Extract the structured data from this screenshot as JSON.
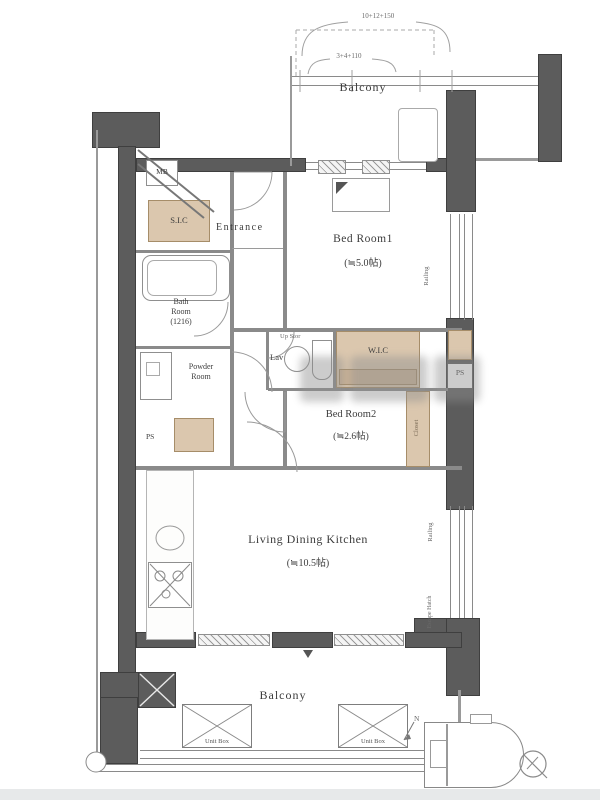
{
  "labels": {
    "balcony_top": "Balcony",
    "balcony_bottom": "Balcony",
    "dim_outer": "10+12+150",
    "dim_inner": "3+4+110",
    "mb": "MB",
    "sic": "S.I.C",
    "entrance": "Entrance",
    "bedroom1_name": "Bed Room1",
    "bedroom1_size": "(≒5.0帖)",
    "bedroom2_name": "Bed Room2",
    "bedroom2_size": "(≒2.6帖)",
    "ldk_name": "Living Dining Kitchen",
    "ldk_size": "(≒10.5帖)",
    "bath_1": "Bath",
    "bath_2": "Room",
    "bath_3": "(1216)",
    "powder_1": "Powder",
    "powder_2": "Room",
    "lav": "Lav",
    "up_stor": "Up Stor",
    "wic": "W.I.C",
    "closet": "Closet",
    "ps_left": "PS",
    "ps_right": "PS",
    "railing_upper": "Railing",
    "railing_lower": "Railing",
    "escape_hatch": "Escape Hatch",
    "unit_box_left": "Unit Box",
    "unit_box_right": "Unit Box",
    "north_mark": "N"
  },
  "colors": {
    "wall": "#5c5c5c",
    "interior_line": "#8a8a8a",
    "closet_fill": "#dbc7ae",
    "closet_border": "#a68d69",
    "text": "#3c3c3c"
  }
}
